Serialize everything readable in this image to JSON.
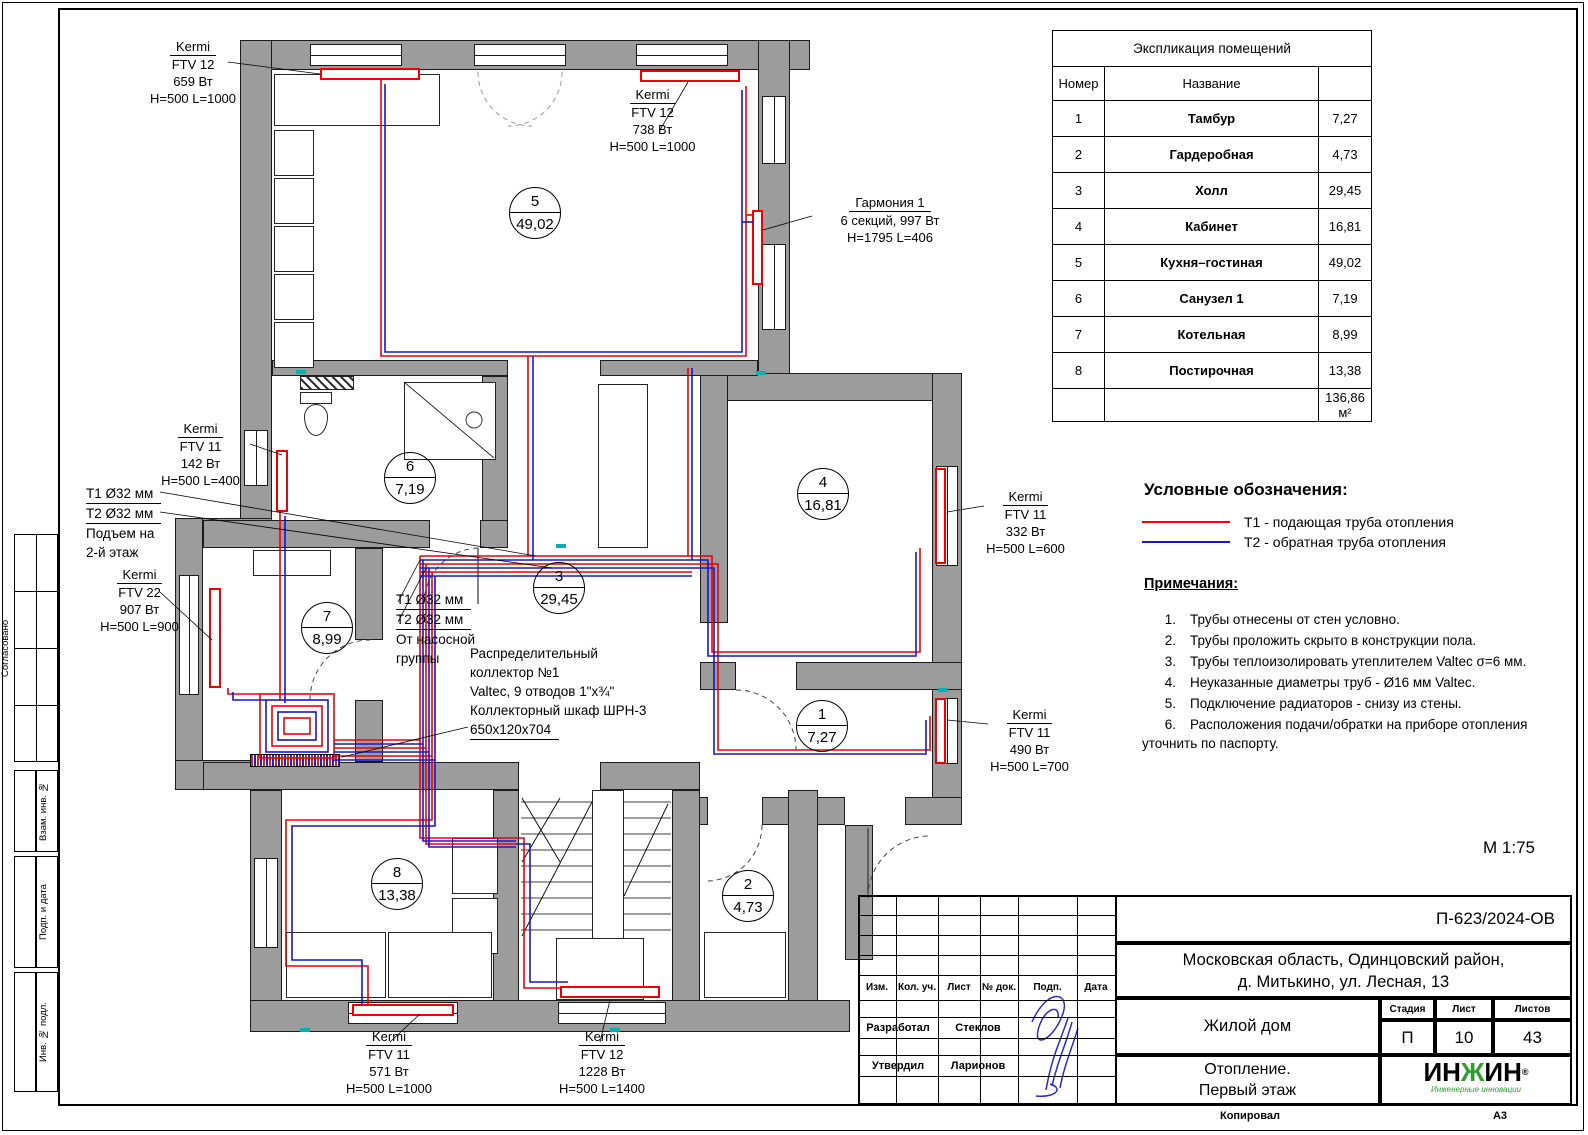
{
  "sheet": {
    "scale": "М 1:75",
    "copied": "Копировал",
    "format": "А3",
    "side": [
      {
        "label": "Согласовано"
      },
      {
        "label": "Взам. инв. №"
      },
      {
        "label": "Подп. и дата"
      },
      {
        "label": "Инв. № подл."
      }
    ]
  },
  "rooms_table": {
    "title": "Экспликация помещений",
    "col_number": "Номер",
    "col_name": "Название",
    "rows": [
      {
        "num": "1",
        "name": "Тамбур",
        "area": "7,27"
      },
      {
        "num": "2",
        "name": "Гардеробная",
        "area": "4,73"
      },
      {
        "num": "3",
        "name": "Холл",
        "area": "29,45"
      },
      {
        "num": "4",
        "name": "Кабинет",
        "area": "16,81"
      },
      {
        "num": "5",
        "name": "Кухня–гостиная",
        "area": "49,02"
      },
      {
        "num": "6",
        "name": "Санузел 1",
        "area": "7,19"
      },
      {
        "num": "7",
        "name": "Котельная",
        "area": "8,99"
      },
      {
        "num": "8",
        "name": "Постирочная",
        "area": "13,38"
      }
    ],
    "total": "136,86 м²"
  },
  "legend": {
    "title": "Условные обозначения:",
    "supply": {
      "label": "Т1 - подающая труба отопления",
      "color": "#ff0000"
    },
    "return": {
      "label": "Т2 - обратная труба отопления",
      "color": "#1616d0"
    },
    "notes_title": "Примечания:",
    "notes": [
      {
        "n": "1.",
        "text": "Трубы отнесены от стен условно."
      },
      {
        "n": "2.",
        "text": "Трубы проложить скрыто в конструкции пола."
      },
      {
        "n": "3.",
        "text": "Трубы теплоизолировать утеплителем Valtec σ=6 мм."
      },
      {
        "n": "4.",
        "text": "Неуказанные диаметры труб - Ø16 мм Valtec."
      },
      {
        "n": "5.",
        "text": "Подключение радиаторов - снизу из стены."
      },
      {
        "n": "6.",
        "text": "Расположения подачи/обратки на приборе отопления уточнить по паспорту."
      }
    ]
  },
  "plan": {
    "labels": [
      {
        "l1": "Kermi",
        "l2": "FTV 12",
        "l3": "659 Вт",
        "l4": "H=500 L=1000"
      },
      {
        "l1": "Kermi",
        "l2": "FTV 12",
        "l3": "738 Вт",
        "l4": "H=500 L=1000"
      },
      {
        "l1": "Гармония 1",
        "l2": "6 секций, 997 Вт",
        "l3": "H=1795 L=406",
        "l4": ""
      },
      {
        "l1": "Kermi",
        "l2": "FTV 11",
        "l3": "142 Вт",
        "l4": "H=500 L=400"
      },
      {
        "l1": "Kermi",
        "l2": "FTV 22",
        "l3": "907 Вт",
        "l4": "H=500 L=900"
      },
      {
        "l1": "Kermi",
        "l2": "FTV 11",
        "l3": "332 Вт",
        "l4": "H=500 L=600"
      },
      {
        "l1": "Kermi",
        "l2": "FTV 11",
        "l3": "490 Вт",
        "l4": "H=500 L=700"
      },
      {
        "l1": "Kermi",
        "l2": "FTV 11",
        "l3": "571 Вт",
        "l4": "H=500 L=1000"
      },
      {
        "l1": "Kermi",
        "l2": "FTV 12",
        "l3": "1228 Вт",
        "l4": "H=500 L=1400"
      }
    ],
    "pipe_labels": {
      "left": {
        "l1": "Т1 Ø32 мм",
        "l2": "Т2 Ø32 мм",
        "l3": "Подъем на",
        "l4": "2-й этаж"
      },
      "mid": {
        "l1": "Т1 Ø32 мм",
        "l2": "Т2 Ø32 мм",
        "l3": "От насосной",
        "l4": "группы"
      }
    },
    "collector": {
      "l1": "Распределительный",
      "l2": "коллектор №1",
      "l3": "Valtec, 9 отводов 1\"x¾\"",
      "l4": "Коллекторный шкаф ШРН-3",
      "l5": "650x120x704"
    },
    "markers": [
      {
        "num": "5",
        "area": "49,02"
      },
      {
        "num": "6",
        "area": "7,19"
      },
      {
        "num": "3",
        "area": "29,45"
      },
      {
        "num": "4",
        "area": "16,81"
      },
      {
        "num": "7",
        "area": "8,99"
      },
      {
        "num": "1",
        "area": "7,27"
      },
      {
        "num": "8",
        "area": "13,38"
      },
      {
        "num": "2",
        "area": "4,73"
      }
    ]
  },
  "titleblock": {
    "doc_number": "П-623/2024-ОВ",
    "address_line1": "Московская область, Одинцовский район,",
    "address_line2": "д. Митькино, ул. Лесная, 13",
    "object": "Жилой дом",
    "sheet_title_line1": "Отопление.",
    "sheet_title_line2": "Первый этаж",
    "stage_label": "Стадия",
    "stage": "П",
    "sheet_label": "Лист",
    "sheet": "10",
    "sheets_label": "Листов",
    "sheets": "43",
    "header_cols": [
      {
        "label": "Изм."
      },
      {
        "label": "Кол. уч."
      },
      {
        "label": "Лист"
      },
      {
        "label": "№ док."
      },
      {
        "label": "Подп."
      },
      {
        "label": "Дата"
      }
    ],
    "roles": [
      {
        "role": "Разработал",
        "name": "Стеклов"
      },
      {
        "role": "Утвердил",
        "name": "Ларионов"
      }
    ],
    "logo_text_1": "ИН",
    "logo_text_g": "Ж",
    "logo_text_2": "ИН",
    "logo_r": "®",
    "logo_sub": "Инженерные инновации"
  },
  "colors": {
    "supply": "#ff0000",
    "return": "#1616d0",
    "wall": "#9c9c9c"
  }
}
